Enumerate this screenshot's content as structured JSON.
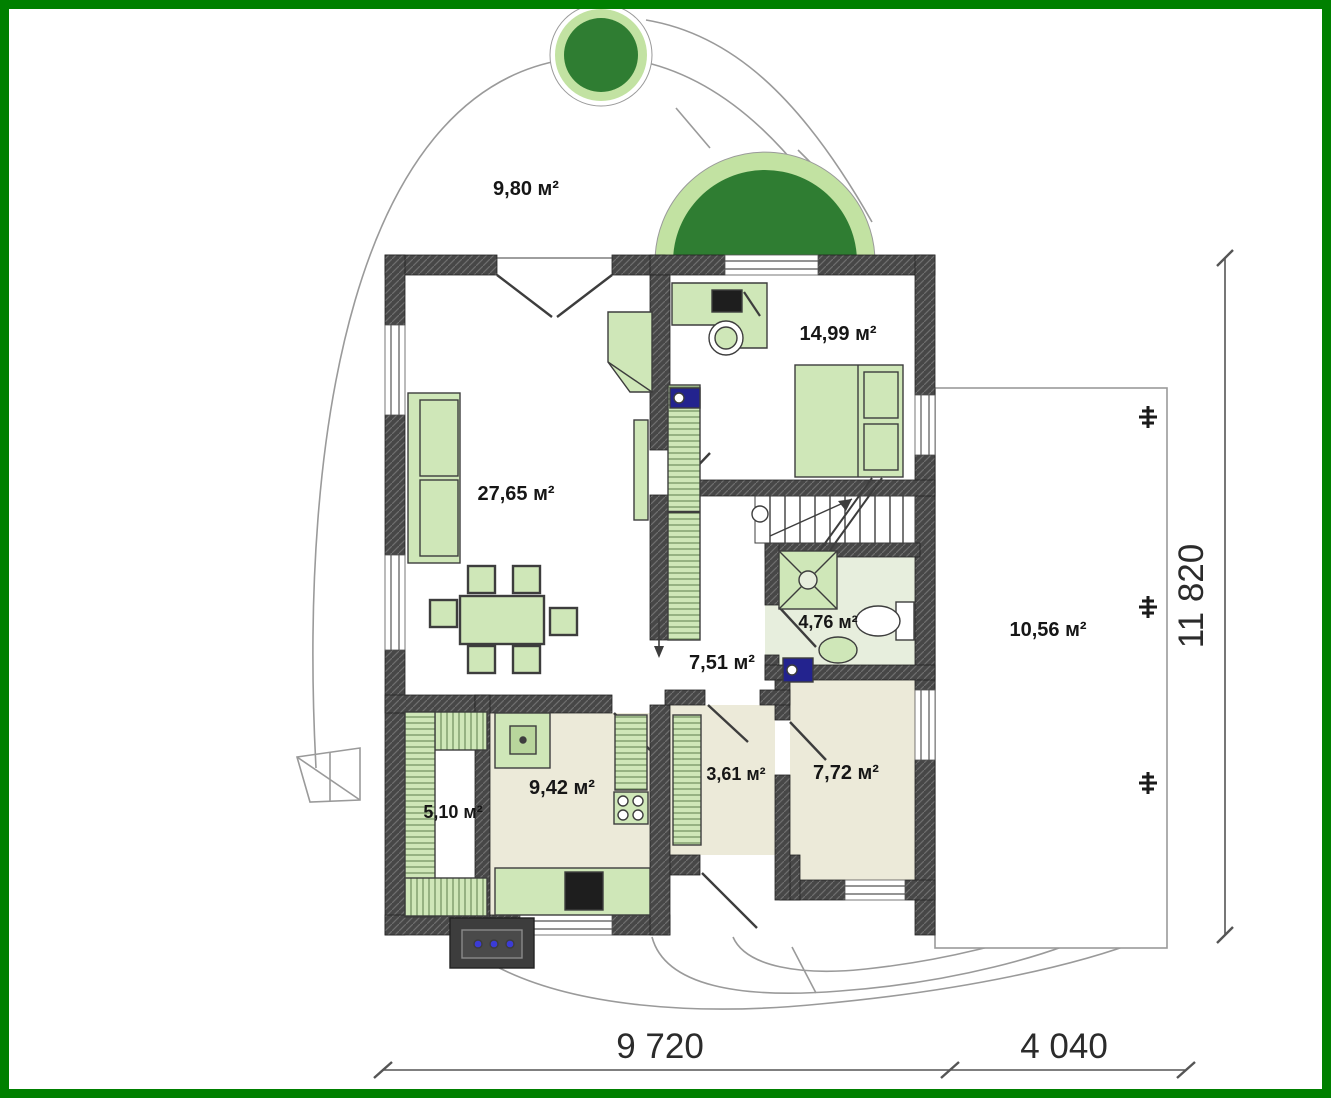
{
  "plan": {
    "rooms": {
      "front_yard": "9,80 м²",
      "bedroom": "14,99 м²",
      "living_room": "27,65 м²",
      "bathroom": "4,76 м²",
      "hallway": "7,51 м²",
      "terrace": "10,56 м²",
      "pantry": "5,10 м²",
      "kitchen": "9,42 м²",
      "entry_hall": "3,61 м²",
      "utility_room": "7,72 м²"
    },
    "dimensions": {
      "width_main": "9 720",
      "width_terrace": "4 040",
      "height_total": "11 820"
    },
    "colors": {
      "frame_green": "#008000",
      "wall_dark": "#474747",
      "furniture_green": "#cfe7b8",
      "tree_dark_green": "#2f7d32",
      "tree_light_ring": "#c2e2a2",
      "floor_beige": "#ecead9",
      "fixture_blue": "#23238e",
      "path_gray": "#9a9a9a"
    }
  }
}
